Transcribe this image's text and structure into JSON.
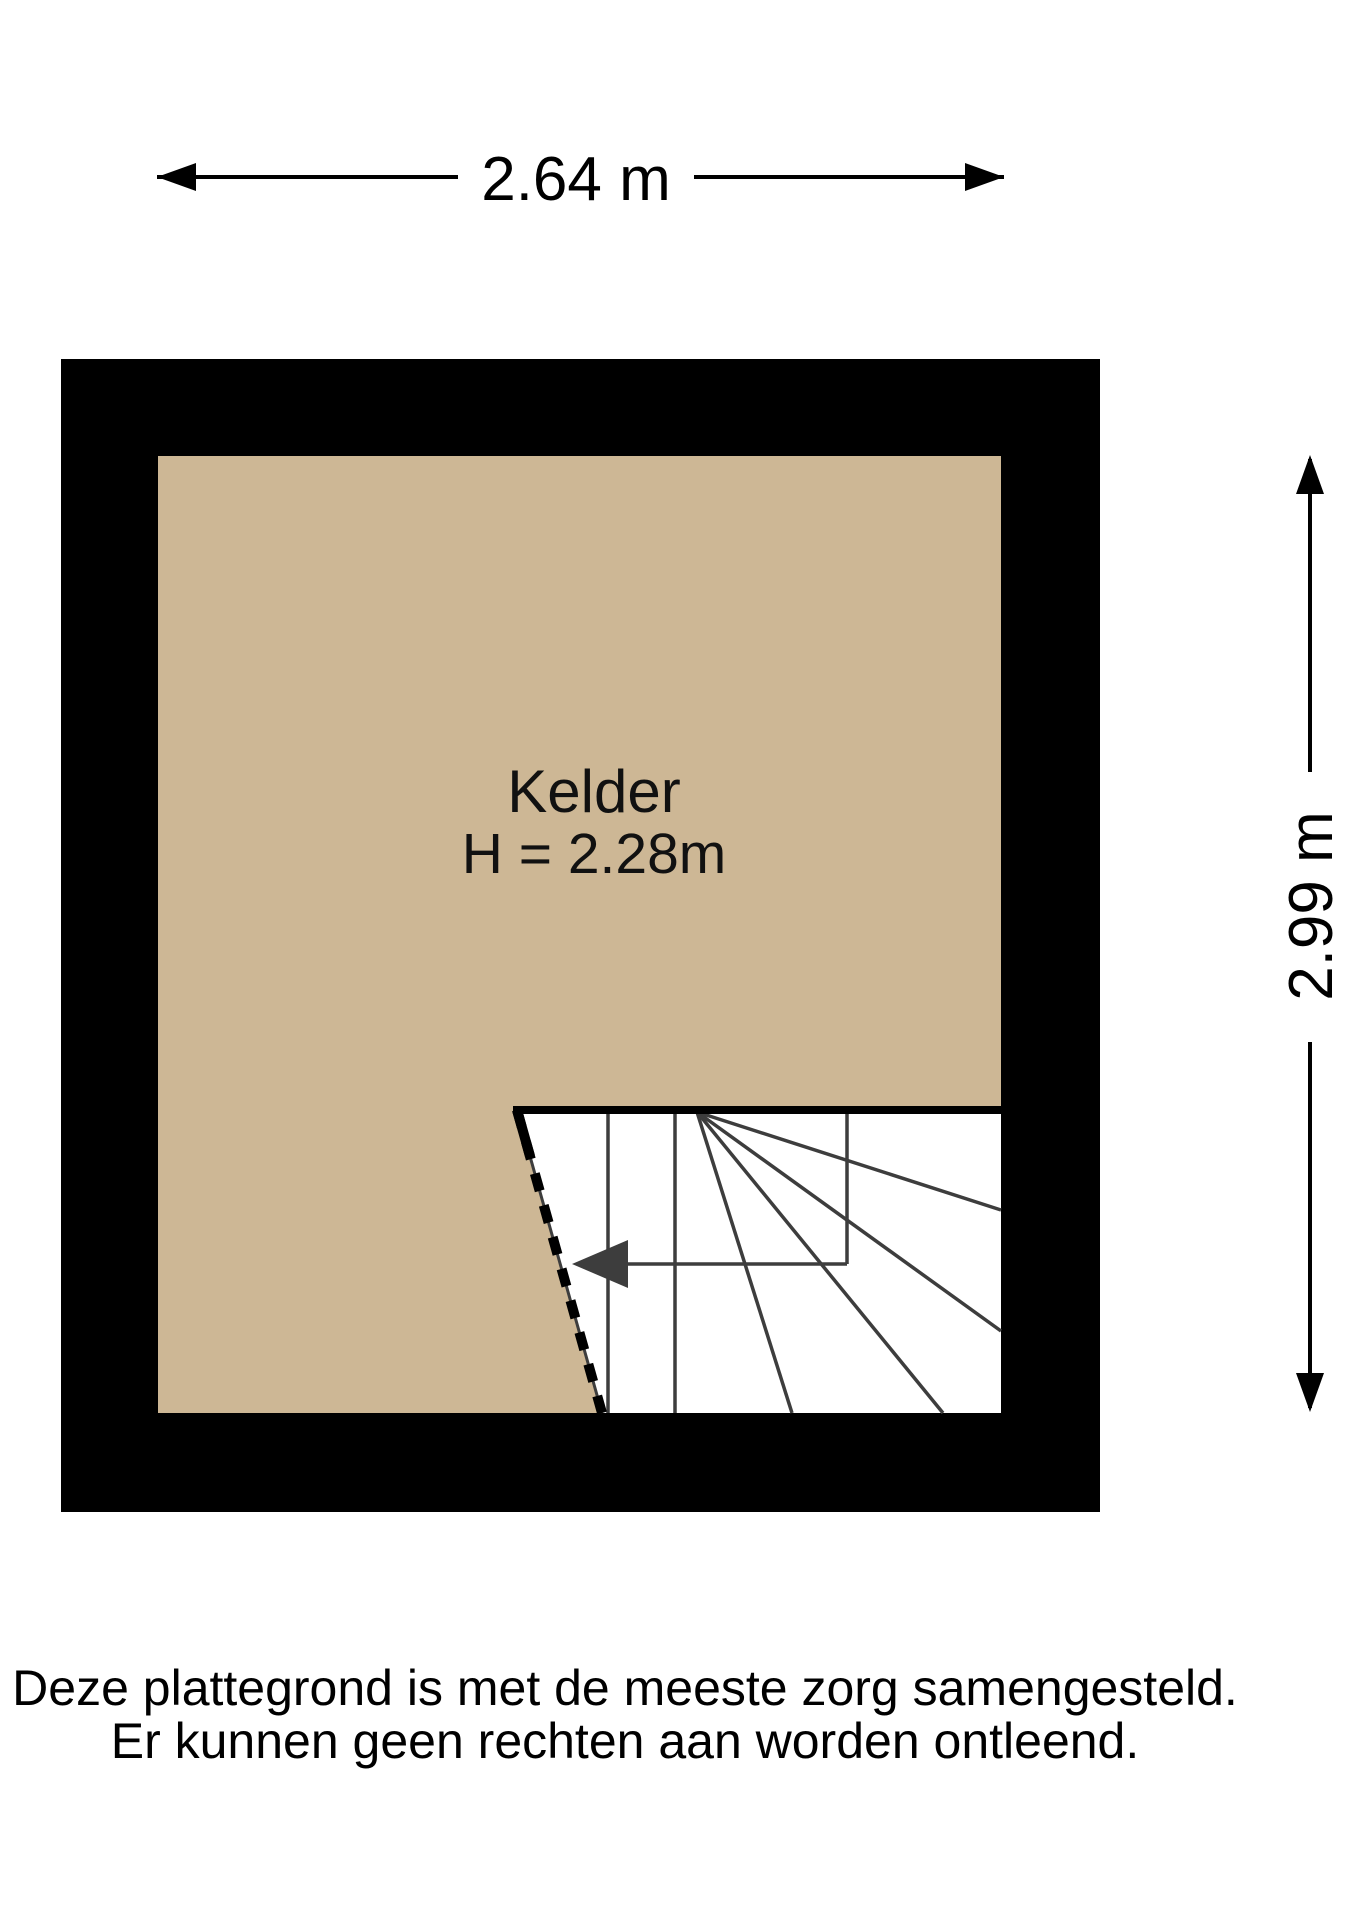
{
  "plan": {
    "room_label": "Kelder",
    "room_height_label": "H = 2.28m",
    "dimension_width": "2.64 m",
    "dimension_height": "2.99 m"
  },
  "disclaimer": {
    "line1": "Deze plattegrond is met de meeste zorg samengesteld.",
    "line2": "Er kunnen geen rechten aan worden ontleend."
  },
  "colors": {
    "wall": "#000000",
    "floor": "#cdb795",
    "stair_fill": "#ffffff",
    "stair_line": "#3d3d3d",
    "dimension": "#000000",
    "text": "#111111"
  }
}
